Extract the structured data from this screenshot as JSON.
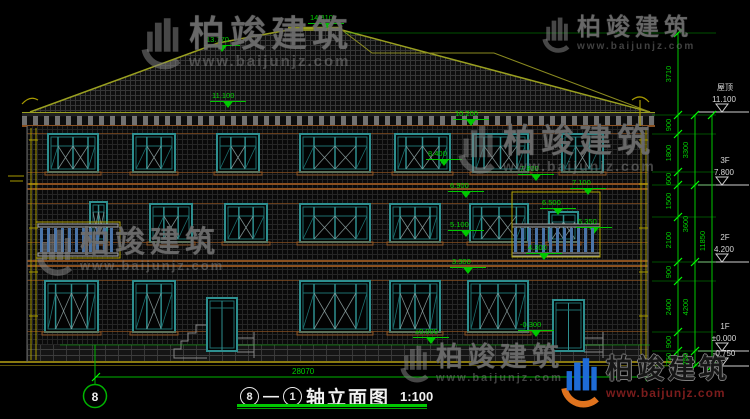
{
  "colors": {
    "dim_green": "#00c800",
    "tick_green": "#00ff00",
    "frame_teal": "#2e8f8f",
    "frame_teal_dark": "#1d6f6f",
    "roof_olive": "#9aa020",
    "band_brown": "#8a5020",
    "pipe_yellow": "#a89a00",
    "balcony_blue": "#4a74a8",
    "white_text": "#d8d8d8",
    "ground_olive": "#8a7a10",
    "logo_blue": "#1e6bd6",
    "logo_orange": "#e0731e",
    "site_red": "#7a1c1c"
  },
  "watermark": {
    "brand": "柏竣建筑",
    "site": "www.baijunjz.com"
  },
  "watermarks": [
    {
      "x": 138,
      "y": 16,
      "fs": 36,
      "icon": 58
    },
    {
      "x": 540,
      "y": 16,
      "fs": 24,
      "icon": 40
    },
    {
      "x": 455,
      "y": 124,
      "fs": 33,
      "icon": 54
    },
    {
      "x": 34,
      "y": 228,
      "fs": 30,
      "icon": 52
    },
    {
      "x": 398,
      "y": 344,
      "fs": 27,
      "icon": 42
    }
  ],
  "brand_footer": {
    "brand": "柏竣建筑",
    "site": "www.baijunjz.com"
  },
  "title_block": {
    "from": "8",
    "sep": "—",
    "to": "1",
    "name": "轴立面图",
    "scale": "1:100"
  },
  "axis_bubble": {
    "label": "8"
  },
  "overall_width_dim": "28070",
  "elevation_markers": [
    {
      "v": "14.810",
      "x": 310,
      "y": 14
    },
    {
      "v": "13.770",
      "x": 206,
      "y": 36
    },
    {
      "v": "11.100",
      "x": 212,
      "y": 92
    },
    {
      "v": "10.200",
      "x": 455,
      "y": 110
    },
    {
      "v": "8.400",
      "x": 428,
      "y": 150
    },
    {
      "v": "7.800",
      "x": 520,
      "y": 165
    },
    {
      "v": "7.100",
      "x": 572,
      "y": 179
    },
    {
      "v": "6.900",
      "x": 450,
      "y": 182
    },
    {
      "v": "6.500",
      "x": 542,
      "y": 199
    },
    {
      "v": "5.350",
      "x": 578,
      "y": 218
    },
    {
      "v": "5.100",
      "x": 450,
      "y": 221
    },
    {
      "v": "4.300",
      "x": 528,
      "y": 244
    },
    {
      "v": "3.300",
      "x": 452,
      "y": 258
    },
    {
      "v": "±0.000",
      "x": 415,
      "y": 328
    },
    {
      "v": "-0.300",
      "x": 520,
      "y": 321
    }
  ],
  "right_levels": [
    {
      "label": "屋顶",
      "elev": "11.100",
      "y": 112
    },
    {
      "label": "3F",
      "elev": "7.800",
      "y": 185
    },
    {
      "label": "2F",
      "elev": "4.200",
      "y": 262
    },
    {
      "label": "1F",
      "elev": "±0.000",
      "y": 351
    },
    {
      "label": "",
      "elev": "-0.750",
      "y": 366
    }
  ],
  "dim_chains": [
    {
      "x": 678,
      "ticks": [
        33,
        115,
        134,
        172,
        185,
        217,
        262,
        281,
        332,
        351,
        366
      ],
      "values": [
        "3710",
        "900",
        "1800",
        "600",
        "1500",
        "2100",
        "900",
        "2400",
        "900",
        "750"
      ]
    },
    {
      "x": 695,
      "ticks": [
        115,
        185,
        262,
        351,
        366
      ],
      "values": [
        "3300",
        "3600",
        "4200",
        "750"
      ]
    },
    {
      "x": 712,
      "ticks": [
        115,
        366
      ],
      "values": [
        "11850"
      ]
    }
  ],
  "geometry": {
    "windows": [
      [
        48,
        134,
        50,
        38,
        "w4"
      ],
      [
        133,
        134,
        42,
        38,
        "w3"
      ],
      [
        217,
        134,
        42,
        38,
        "w3"
      ],
      [
        300,
        134,
        70,
        38,
        "w4"
      ],
      [
        395,
        134,
        55,
        38,
        "w4"
      ],
      [
        473,
        134,
        55,
        38,
        "w4"
      ],
      [
        562,
        134,
        41,
        38,
        "w3"
      ],
      [
        90,
        202,
        17,
        40,
        "w1"
      ],
      [
        150,
        204,
        42,
        38,
        "w3"
      ],
      [
        225,
        204,
        42,
        38,
        "w3"
      ],
      [
        300,
        204,
        70,
        38,
        "w4"
      ],
      [
        390,
        204,
        50,
        38,
        "w4"
      ],
      [
        470,
        204,
        58,
        38,
        "w4"
      ],
      [
        549,
        212,
        29,
        30,
        "w1"
      ],
      [
        45,
        281,
        53,
        51,
        "w4"
      ],
      [
        133,
        281,
        42,
        51,
        "w3"
      ],
      [
        300,
        281,
        70,
        51,
        "w4"
      ],
      [
        390,
        281,
        50,
        51,
        "w4"
      ],
      [
        468,
        281,
        60,
        51,
        "w4"
      ]
    ],
    "doors": [
      [
        207,
        298,
        30,
        53
      ],
      [
        553,
        300,
        31,
        51
      ]
    ],
    "balconies": [
      {
        "rail": [
          38,
          224,
          80,
          32
        ],
        "box": [
          36,
          222,
          84,
          36
        ]
      },
      {
        "rail": [
          512,
          224,
          88,
          32
        ],
        "box": [
          512,
          192,
          88,
          65
        ]
      }
    ]
  }
}
